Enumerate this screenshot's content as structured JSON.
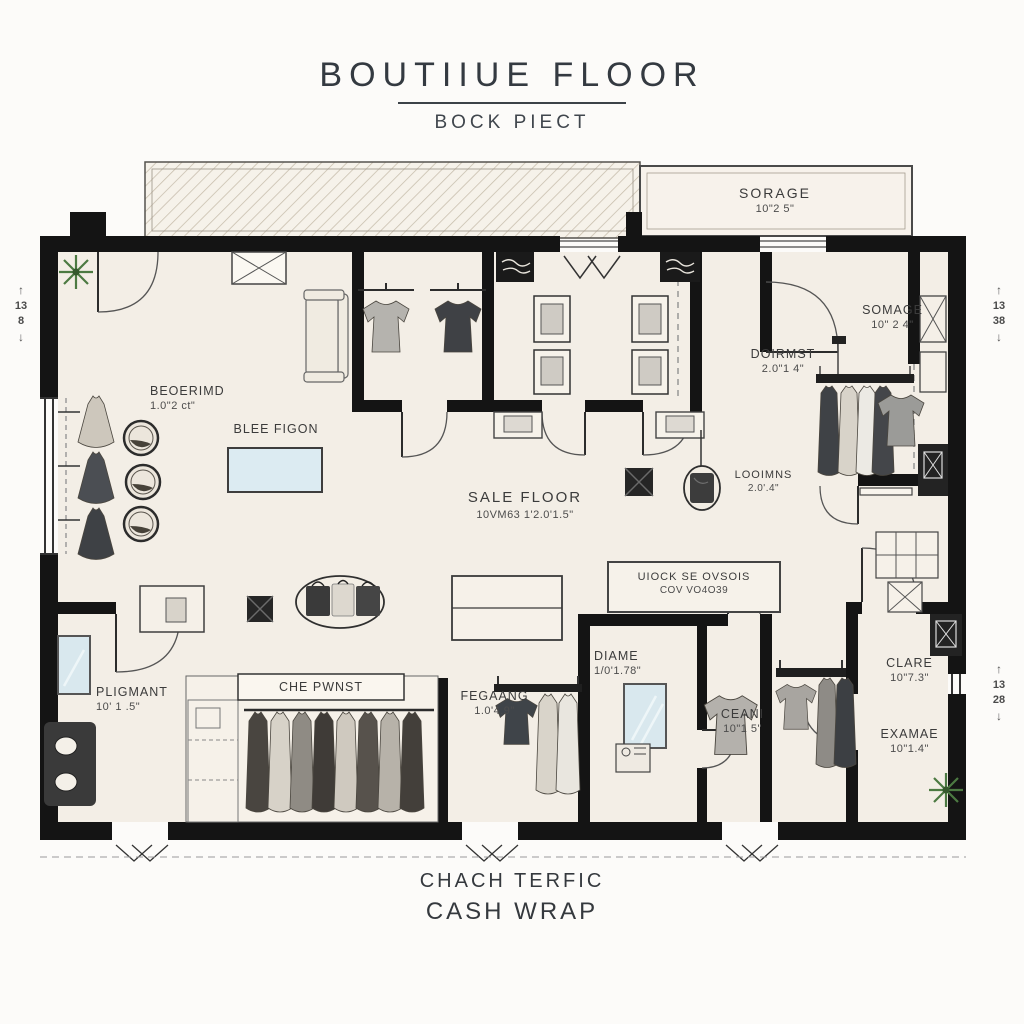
{
  "title": {
    "main": "BOUTIIUE FLOOR",
    "sub": "BOCK PIECT"
  },
  "footer": {
    "line1": "CHACH TERFIC",
    "line2": "CASH WRAP"
  },
  "rooms": {
    "sorage_top": {
      "name": "SORAGE",
      "dims": "10\"2 5\""
    },
    "beoerimd": {
      "name": "BEOERIMD",
      "dims": "1.0\"2 ct\""
    },
    "blee_figon": {
      "name": "BLEE FIGON",
      "dims": ""
    },
    "sale_floor": {
      "name": "SALE FLOOR",
      "dims": "10VM63 1'2.0'1.5\""
    },
    "somage": {
      "name": "SOMAGE",
      "dims": "10\" 2 4\""
    },
    "doirmst": {
      "name": "DOIRMST",
      "dims": "2.0\"1 4\""
    },
    "looimns": {
      "name": "LOOIMNS",
      "dims": "2.0'.4\""
    },
    "uiock": {
      "name": "UIOCK SE OVSOIS",
      "dims": "COV VO4O39"
    },
    "diame": {
      "name": "DIAME",
      "dims": "1/0'1.78\""
    },
    "ceani": {
      "name": "CEANI",
      "dims": "10\"1 5\""
    },
    "clare": {
      "name": "CLARE",
      "dims": "10\"7.3\""
    },
    "examae": {
      "name": "EXAMAE",
      "dims": "10\"1.4\""
    },
    "pligmant": {
      "name": "PLIGMANT",
      "dims": "10' 1 .5\""
    },
    "chepwnst": {
      "name": "CHE PWNST",
      "dims": ""
    },
    "regaang": {
      "name": "FEGAANG",
      "dims": "1.0'4.9\""
    }
  },
  "dims": {
    "arrow_up": "↑",
    "arrow_down": "↓",
    "left": {
      "top": "13",
      "bottom": "8"
    },
    "right_top": {
      "top": "13",
      "bottom": "38"
    },
    "right_bottom": {
      "top": "13",
      "bottom": "28"
    }
  },
  "colors": {
    "wall": "#141414",
    "floor": "#f3eee6",
    "mirror_blue": "#d9e8ee",
    "plant_green": "#4c7a42"
  }
}
